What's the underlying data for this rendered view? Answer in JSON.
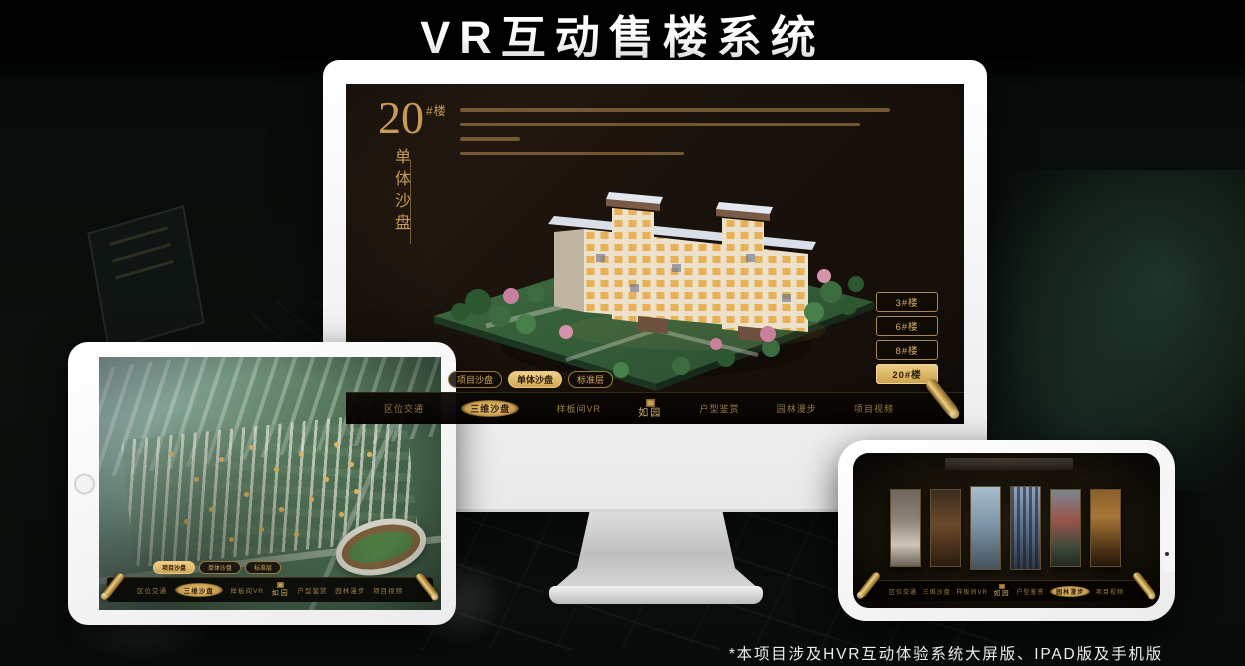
{
  "page": {
    "title": "VR互动售楼系统",
    "footnote": "*本项目涉及HVR互动体验系统大屏版、IPAD版及手机版"
  },
  "theme": {
    "gold": "#d2a95f",
    "gold_bright": "#ecc87b",
    "screen_bg": "#1c140e",
    "frame_white": "#f7f7f7"
  },
  "desktop": {
    "heading": {
      "number": "20",
      "unit": "#楼",
      "subtitle": "单体沙盘"
    },
    "building_buttons": [
      {
        "label": "3#楼",
        "active": false
      },
      {
        "label": "6#楼",
        "active": false
      },
      {
        "label": "8#楼",
        "active": false
      },
      {
        "label": "20#楼",
        "active": true
      }
    ],
    "tabs": [
      {
        "label": "项目沙盘",
        "active": false
      },
      {
        "label": "单体沙盘",
        "active": true
      },
      {
        "label": "标准层",
        "active": false
      }
    ],
    "menu": [
      {
        "label": "区位交通",
        "active": false
      },
      {
        "label": "三维沙盘",
        "active": true
      },
      {
        "label": "样板间VR",
        "active": false
      },
      {
        "label": "户型鉴赏",
        "active": false
      },
      {
        "label": "园林漫步",
        "active": false
      },
      {
        "label": "项目视频",
        "active": false
      }
    ],
    "logo": "如园"
  },
  "tablet": {
    "tabs": [
      {
        "label": "项目沙盘",
        "active": true
      },
      {
        "label": "单体沙盘",
        "active": false
      },
      {
        "label": "标准层",
        "active": false
      }
    ],
    "menu": [
      {
        "label": "区位交通",
        "active": false
      },
      {
        "label": "三维沙盘",
        "active": true
      },
      {
        "label": "样板间VR",
        "active": false
      },
      {
        "label": "户型鉴赏",
        "active": false
      },
      {
        "label": "园林漫步",
        "active": false
      },
      {
        "label": "项目视频",
        "active": false
      }
    ],
    "logo": "如园"
  },
  "phone": {
    "menu": [
      {
        "label": "区位交通",
        "active": false
      },
      {
        "label": "三维沙盘",
        "active": false
      },
      {
        "label": "样板间VR",
        "active": false
      },
      {
        "label": "户型鉴赏",
        "active": false
      },
      {
        "label": "园林漫步",
        "active": true
      },
      {
        "label": "项目视频",
        "active": false
      }
    ],
    "logo": "如园"
  }
}
